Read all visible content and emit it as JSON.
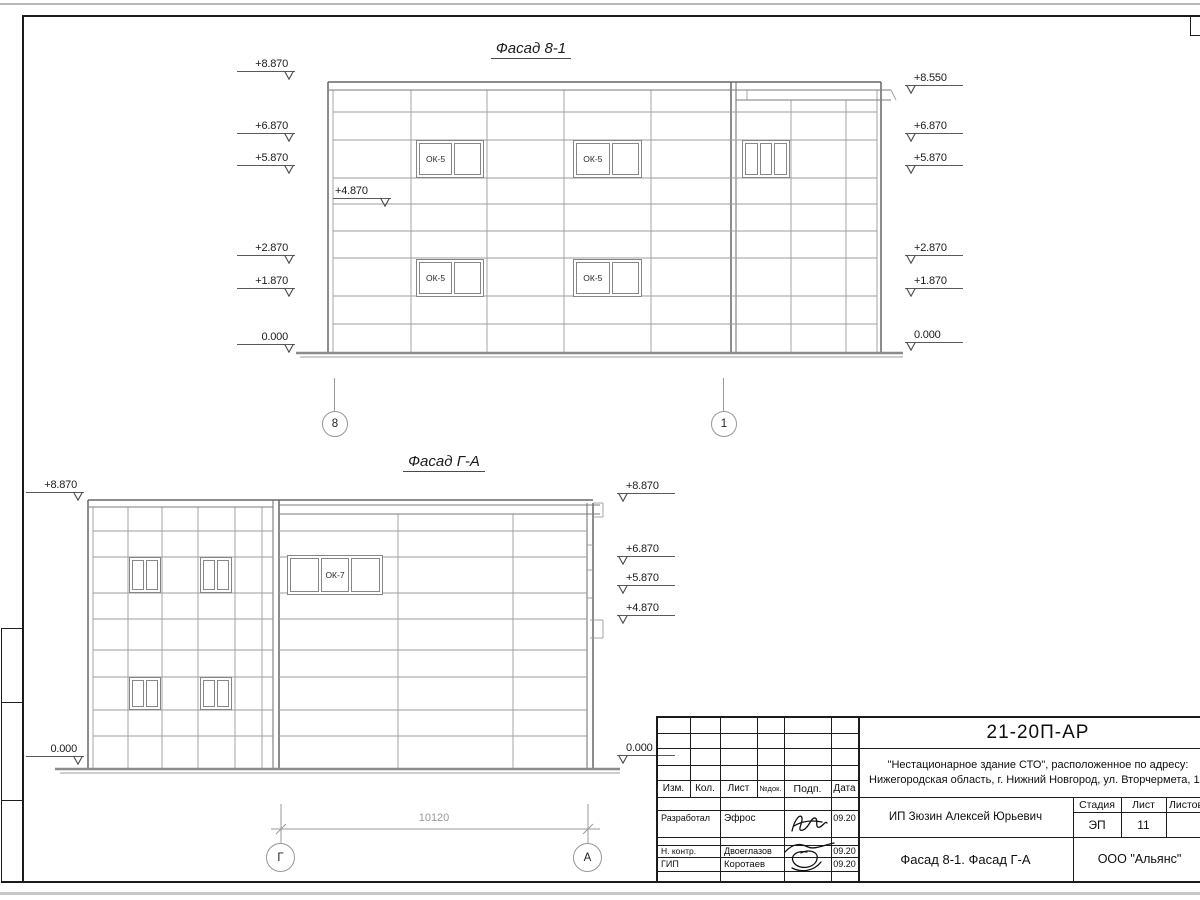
{
  "facade_81": {
    "title": "Фасад 8-1",
    "left_marks": [
      "+8.870",
      "+6.870",
      "+5.870",
      "+2.870",
      "+1.870",
      "0.000"
    ],
    "inner_mark": "+4.870",
    "right_marks": [
      "+8.550",
      "+6.870",
      "+5.870",
      "+2.870",
      "+1.870",
      "0.000"
    ],
    "window_label": "ОК-5",
    "axis_left": "8",
    "axis_right": "1"
  },
  "facade_ga": {
    "title": "Фасад Г-А",
    "left_marks": [
      "+8.870",
      "0.000"
    ],
    "right_marks": [
      "+8.870",
      "+6.870",
      "+5.870",
      "+4.870",
      "0.000"
    ],
    "window_label": "ОК-7",
    "axis_left": "Г",
    "axis_right": "А",
    "dimension": "10120"
  },
  "title_block": {
    "doc_code": "21-20П-АР",
    "object_line1": "\"Нестационарное здание СТО\", расположенное по адресу:",
    "object_line2": "Нижегородская область, г. Нижний Новгород, ул. Вторчермета, 1А",
    "client": "ИП Зюзин Алексей Юрьевич",
    "drawing_title": "Фасад 8-1. Фасад Г-А",
    "organization": "ООО \"Альянс\"",
    "stage_label": "Стадия",
    "sheet_label": "Лист",
    "sheets_label": "Листов",
    "stage_value": "ЭП",
    "sheet_value": "11",
    "columns": [
      "Изм.",
      "Кол.",
      "Лист",
      "№док.",
      "Подп.",
      "Дата"
    ],
    "signatures": [
      {
        "role": "Разработал",
        "name": "Эфрос",
        "date": "09.20"
      },
      {
        "role": "Н. контр.",
        "name": "Двоеглазов",
        "date": "09.20"
      },
      {
        "role": "ГИП",
        "name": "Коротаев",
        "date": "09.20"
      }
    ]
  }
}
